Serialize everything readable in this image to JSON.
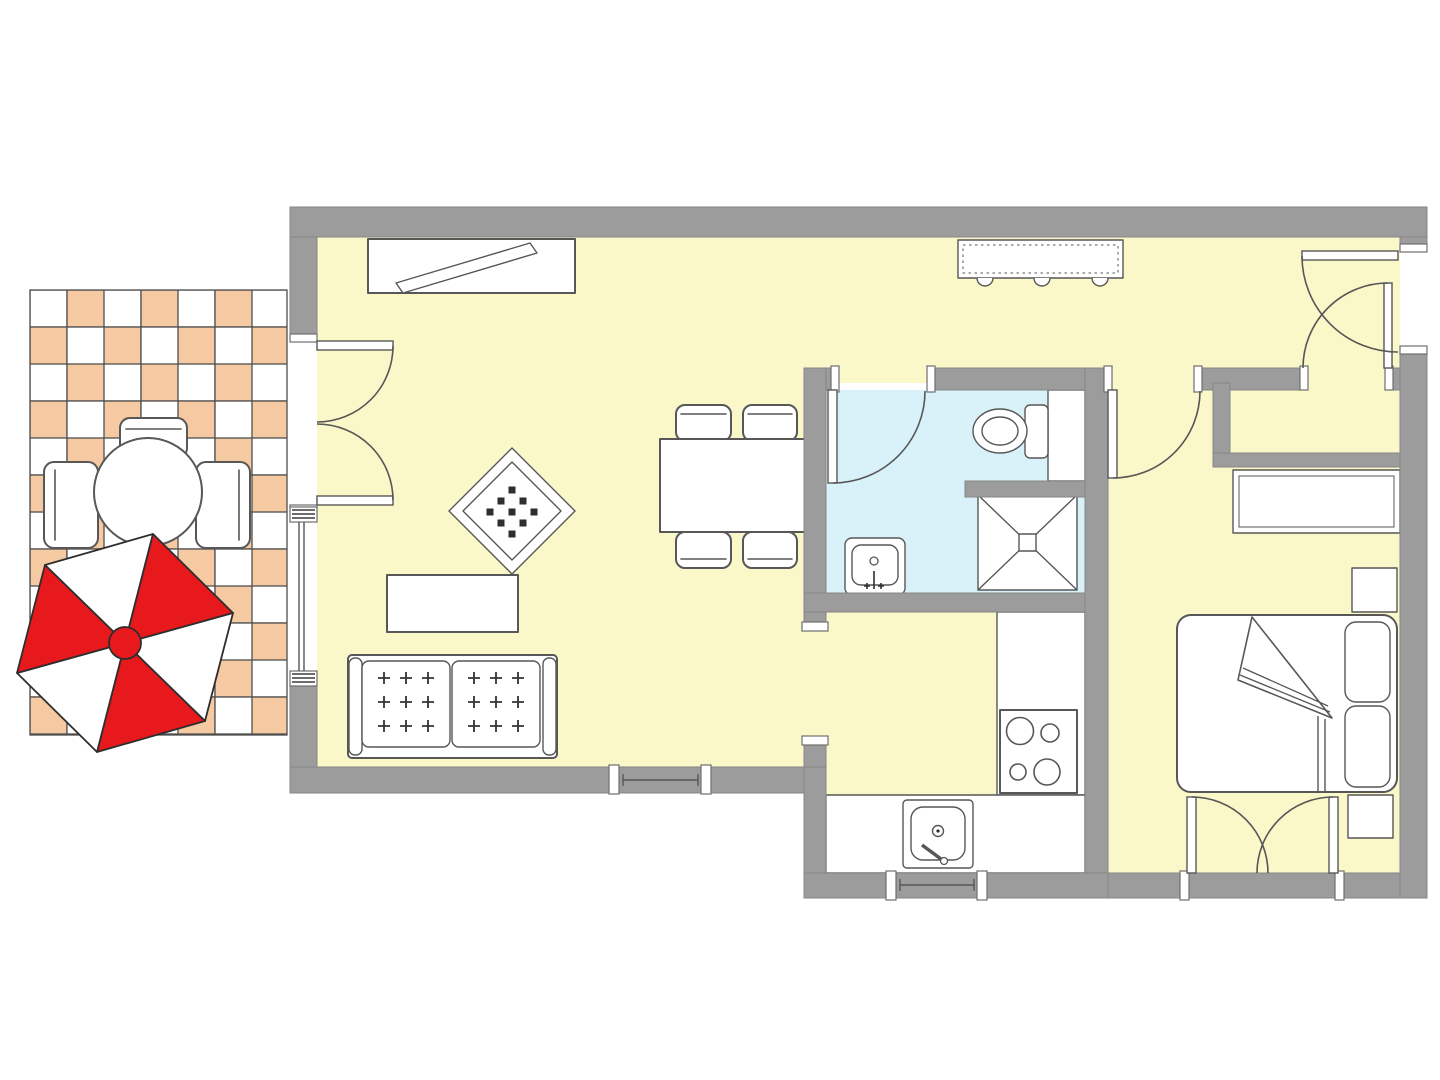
{
  "plan": {
    "type": "apartment-floor-plan",
    "rooms": [
      {
        "id": "terrace",
        "floor": "checkerboard-tiles"
      },
      {
        "id": "living-room",
        "floor": "yellow"
      },
      {
        "id": "entrance-hall",
        "floor": "yellow"
      },
      {
        "id": "bathroom",
        "floor": "blue"
      },
      {
        "id": "kitchen",
        "floor": "yellow"
      },
      {
        "id": "bedroom",
        "floor": "yellow"
      },
      {
        "id": "hall-closet",
        "floor": "yellow"
      }
    ],
    "furniture": {
      "terrace": [
        "round-table",
        "chair",
        "chair",
        "chair",
        "parasol"
      ],
      "living_room": [
        "tv-sideboard",
        "sofa",
        "coffee-table",
        "rug",
        "dining-table",
        "dining-chair",
        "dining-chair",
        "dining-chair",
        "dining-chair"
      ],
      "entrance_hall": [
        "sideboard"
      ],
      "bathroom": [
        "toilet",
        "shower",
        "washbasin"
      ],
      "kitchen": [
        "counter",
        "stove",
        "kitchen-sink"
      ],
      "bedroom": [
        "double-bed",
        "pillow",
        "pillow",
        "wardrobe",
        "nightstand",
        "nightstand"
      ]
    },
    "openings": [
      "terrace-french-door",
      "left-window",
      "living-bottom-window",
      "kitchen-door",
      "kitchen-window",
      "bathroom-door",
      "bedroom-door",
      "closet-door",
      "entrance-door",
      "bedroom-french-window"
    ]
  },
  "colors": {
    "background": "#ffffff",
    "wall": "#9c9c9c",
    "floor_yellow": "#faf7c9",
    "floor_blue": "#d9f1f8",
    "tile_peach": "#f5c9a1",
    "tile_white": "#ffffff",
    "tile_grid": "#4f4f4f",
    "outline": "#575757",
    "parasol_red": "#e8191d",
    "parasol_white": "#ffffff",
    "furniture_fill": "#ffffff"
  }
}
